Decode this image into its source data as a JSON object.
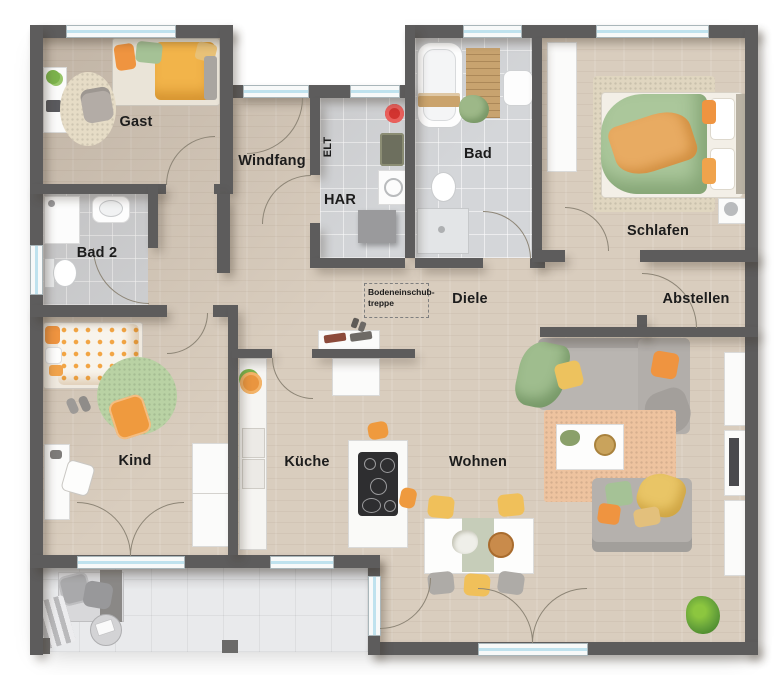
{
  "plan_title": "apartment-floor-plan",
  "rooms": {
    "gast": {
      "label": "Gast"
    },
    "windfang": {
      "label": "Windfang"
    },
    "elt": {
      "label": "ELT"
    },
    "har": {
      "label": "HAR"
    },
    "bad": {
      "label": "Bad"
    },
    "schlafen": {
      "label": "Schlafen"
    },
    "bad2": {
      "label": "Bad 2"
    },
    "diele": {
      "label": "Diele"
    },
    "abstellen": {
      "label": "Abstellen"
    },
    "kind": {
      "label": "Kind"
    },
    "kueche": {
      "label": "Küche"
    },
    "wohnen": {
      "label": "Wohnen"
    }
  },
  "annotations": {
    "attic_hatch_line1": "Bodeneinschub-",
    "attic_hatch_line2": "treppe"
  },
  "colors": {
    "wall": "#5d5c5c",
    "wood_floor": "#d9cdbe",
    "tile_floor": "#d4d6d9",
    "terrace": "#e9eaec",
    "window_glass": "#bfe2ee",
    "accent_orange": "#ef9a3e",
    "accent_yellow": "#edc25e",
    "accent_green": "#a5c296",
    "rug_salmon": "#eec39f"
  }
}
